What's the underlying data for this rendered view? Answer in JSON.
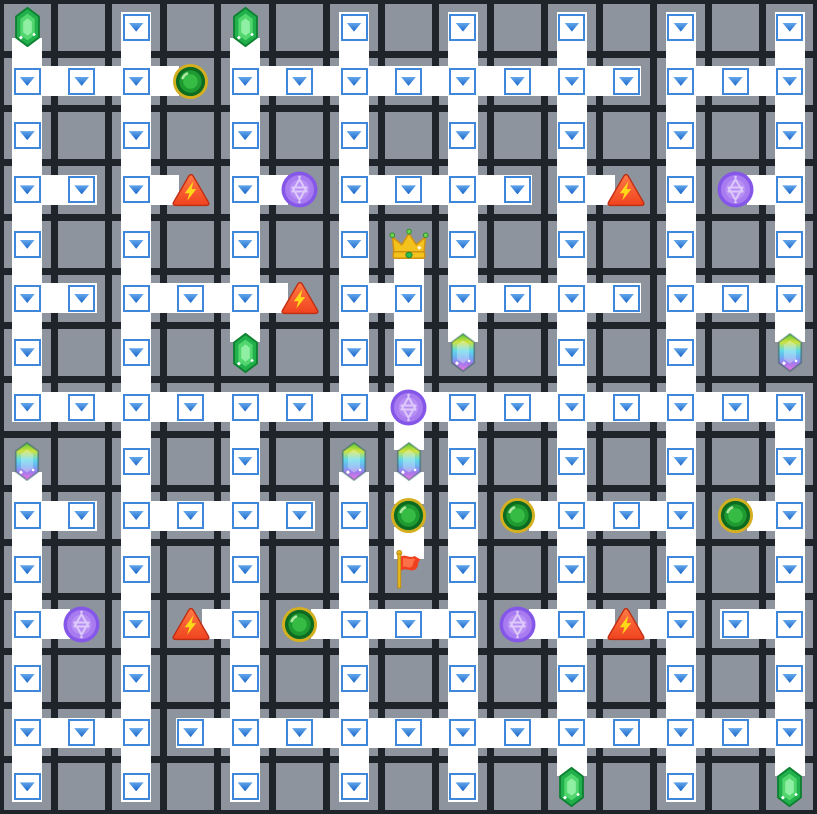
{
  "app": {
    "title": "maze grid puzzle board"
  },
  "board": {
    "cols": 15,
    "rows": 15,
    "colors": {
      "bg": "#1f242b",
      "tile": "#8d949d",
      "path": "#ffffff",
      "boxBorder": "#3e87da",
      "arrowTop": "#63a7ec",
      "arrowBottom": "#1b66c9"
    },
    "path_cells": [
      [
        2,
        0
      ],
      [
        6,
        0
      ],
      [
        8,
        0
      ],
      [
        10,
        0
      ],
      [
        12,
        0
      ],
      [
        14,
        0
      ],
      [
        0,
        1
      ],
      [
        1,
        1
      ],
      [
        2,
        1
      ],
      [
        4,
        1
      ],
      [
        5,
        1
      ],
      [
        6,
        1
      ],
      [
        7,
        1
      ],
      [
        8,
        1
      ],
      [
        9,
        1
      ],
      [
        10,
        1
      ],
      [
        11,
        1
      ],
      [
        12,
        1
      ],
      [
        13,
        1
      ],
      [
        14,
        1
      ],
      [
        0,
        2
      ],
      [
        2,
        2
      ],
      [
        4,
        2
      ],
      [
        6,
        2
      ],
      [
        8,
        2
      ],
      [
        10,
        2
      ],
      [
        12,
        2
      ],
      [
        14,
        2
      ],
      [
        0,
        3
      ],
      [
        1,
        3
      ],
      [
        2,
        3
      ],
      [
        4,
        3
      ],
      [
        6,
        3
      ],
      [
        7,
        3
      ],
      [
        8,
        3
      ],
      [
        9,
        3
      ],
      [
        10,
        3
      ],
      [
        12,
        3
      ],
      [
        14,
        3
      ],
      [
        0,
        4
      ],
      [
        2,
        4
      ],
      [
        4,
        4
      ],
      [
        6,
        4
      ],
      [
        8,
        4
      ],
      [
        10,
        4
      ],
      [
        12,
        4
      ],
      [
        14,
        4
      ],
      [
        0,
        5
      ],
      [
        1,
        5
      ],
      [
        2,
        5
      ],
      [
        3,
        5
      ],
      [
        4,
        5
      ],
      [
        6,
        5
      ],
      [
        7,
        5
      ],
      [
        8,
        5
      ],
      [
        9,
        5
      ],
      [
        10,
        5
      ],
      [
        11,
        5
      ],
      [
        12,
        5
      ],
      [
        13,
        5
      ],
      [
        14,
        5
      ],
      [
        0,
        6
      ],
      [
        2,
        6
      ],
      [
        6,
        6
      ],
      [
        7,
        6
      ],
      [
        10,
        6
      ],
      [
        12,
        6
      ],
      [
        0,
        7
      ],
      [
        1,
        7
      ],
      [
        2,
        7
      ],
      [
        3,
        7
      ],
      [
        4,
        7
      ],
      [
        5,
        7
      ],
      [
        6,
        7
      ],
      [
        8,
        7
      ],
      [
        9,
        7
      ],
      [
        10,
        7
      ],
      [
        11,
        7
      ],
      [
        12,
        7
      ],
      [
        13,
        7
      ],
      [
        14,
        7
      ],
      [
        2,
        8
      ],
      [
        4,
        8
      ],
      [
        8,
        8
      ],
      [
        10,
        8
      ],
      [
        12,
        8
      ],
      [
        14,
        8
      ],
      [
        0,
        9
      ],
      [
        1,
        9
      ],
      [
        2,
        9
      ],
      [
        3,
        9
      ],
      [
        4,
        9
      ],
      [
        5,
        9
      ],
      [
        6,
        9
      ],
      [
        8,
        9
      ],
      [
        10,
        9
      ],
      [
        11,
        9
      ],
      [
        12,
        9
      ],
      [
        14,
        9
      ],
      [
        0,
        10
      ],
      [
        2,
        10
      ],
      [
        4,
        10
      ],
      [
        6,
        10
      ],
      [
        8,
        10
      ],
      [
        10,
        10
      ],
      [
        12,
        10
      ],
      [
        14,
        10
      ],
      [
        0,
        11
      ],
      [
        2,
        11
      ],
      [
        4,
        11
      ],
      [
        6,
        11
      ],
      [
        7,
        11
      ],
      [
        8,
        11
      ],
      [
        10,
        11
      ],
      [
        12,
        11
      ],
      [
        13,
        11
      ],
      [
        14,
        11
      ],
      [
        0,
        12
      ],
      [
        2,
        12
      ],
      [
        4,
        12
      ],
      [
        6,
        12
      ],
      [
        8,
        12
      ],
      [
        10,
        12
      ],
      [
        12,
        12
      ],
      [
        14,
        12
      ],
      [
        0,
        13
      ],
      [
        1,
        13
      ],
      [
        2,
        13
      ],
      [
        3,
        13
      ],
      [
        4,
        13
      ],
      [
        5,
        13
      ],
      [
        6,
        13
      ],
      [
        7,
        13
      ],
      [
        8,
        13
      ],
      [
        9,
        13
      ],
      [
        10,
        13
      ],
      [
        11,
        13
      ],
      [
        12,
        13
      ],
      [
        13,
        13
      ],
      [
        14,
        13
      ],
      [
        0,
        14
      ],
      [
        2,
        14
      ],
      [
        4,
        14
      ],
      [
        6,
        14
      ],
      [
        8,
        14
      ],
      [
        12,
        14
      ]
    ],
    "h_edges": [
      [
        0,
        1
      ],
      [
        1,
        1
      ],
      [
        2,
        1
      ],
      [
        4,
        1
      ],
      [
        5,
        1
      ],
      [
        6,
        1
      ],
      [
        7,
        1
      ],
      [
        8,
        1
      ],
      [
        9,
        1
      ],
      [
        10,
        1
      ],
      [
        12,
        1
      ],
      [
        13,
        1
      ],
      [
        0,
        3
      ],
      [
        2,
        3
      ],
      [
        4,
        3
      ],
      [
        6,
        3
      ],
      [
        7,
        3
      ],
      [
        8,
        3
      ],
      [
        10,
        3
      ],
      [
        13,
        3
      ],
      [
        0,
        5
      ],
      [
        2,
        5
      ],
      [
        3,
        5
      ],
      [
        4,
        5
      ],
      [
        6,
        5
      ],
      [
        8,
        5
      ],
      [
        9,
        5
      ],
      [
        10,
        5
      ],
      [
        12,
        5
      ],
      [
        13,
        5
      ],
      [
        0,
        7
      ],
      [
        1,
        7
      ],
      [
        2,
        7
      ],
      [
        3,
        7
      ],
      [
        4,
        7
      ],
      [
        5,
        7
      ],
      [
        6,
        7
      ],
      [
        7,
        7
      ],
      [
        8,
        7
      ],
      [
        9,
        7
      ],
      [
        10,
        7
      ],
      [
        11,
        7
      ],
      [
        12,
        7
      ],
      [
        13,
        7
      ],
      [
        0,
        9
      ],
      [
        2,
        9
      ],
      [
        3,
        9
      ],
      [
        4,
        9
      ],
      [
        9,
        9
      ],
      [
        10,
        9
      ],
      [
        11,
        9
      ],
      [
        13,
        9
      ],
      [
        0,
        11
      ],
      [
        3,
        11
      ],
      [
        5,
        11
      ],
      [
        6,
        11
      ],
      [
        7,
        11
      ],
      [
        9,
        11
      ],
      [
        10,
        11
      ],
      [
        11,
        11
      ],
      [
        13,
        11
      ],
      [
        0,
        13
      ],
      [
        1,
        13
      ],
      [
        3,
        13
      ],
      [
        4,
        13
      ],
      [
        5,
        13
      ],
      [
        6,
        13
      ],
      [
        7,
        13
      ],
      [
        8,
        13
      ],
      [
        9,
        13
      ],
      [
        10,
        13
      ],
      [
        11,
        13
      ],
      [
        12,
        13
      ],
      [
        13,
        13
      ]
    ],
    "v_edges": [
      [
        0,
        0
      ],
      [
        0,
        1
      ],
      [
        0,
        2
      ],
      [
        0,
        3
      ],
      [
        0,
        4
      ],
      [
        0,
        5
      ],
      [
        0,
        6
      ],
      [
        0,
        8
      ],
      [
        0,
        9
      ],
      [
        0,
        10
      ],
      [
        0,
        11
      ],
      [
        0,
        12
      ],
      [
        0,
        13
      ],
      [
        2,
        0
      ],
      [
        2,
        1
      ],
      [
        2,
        2
      ],
      [
        2,
        3
      ],
      [
        2,
        4
      ],
      [
        2,
        5
      ],
      [
        2,
        6
      ],
      [
        2,
        7
      ],
      [
        2,
        8
      ],
      [
        2,
        9
      ],
      [
        2,
        10
      ],
      [
        2,
        11
      ],
      [
        2,
        12
      ],
      [
        2,
        13
      ],
      [
        4,
        0
      ],
      [
        4,
        1
      ],
      [
        4,
        2
      ],
      [
        4,
        3
      ],
      [
        4,
        4
      ],
      [
        4,
        5
      ],
      [
        4,
        7
      ],
      [
        4,
        8
      ],
      [
        4,
        9
      ],
      [
        4,
        10
      ],
      [
        4,
        11
      ],
      [
        4,
        12
      ],
      [
        4,
        13
      ],
      [
        6,
        0
      ],
      [
        6,
        1
      ],
      [
        6,
        2
      ],
      [
        6,
        3
      ],
      [
        6,
        4
      ],
      [
        6,
        5
      ],
      [
        6,
        6
      ],
      [
        6,
        8
      ],
      [
        6,
        9
      ],
      [
        6,
        10
      ],
      [
        6,
        11
      ],
      [
        6,
        12
      ],
      [
        6,
        13
      ],
      [
        7,
        4
      ],
      [
        7,
        5
      ],
      [
        7,
        6
      ],
      [
        7,
        7
      ],
      [
        7,
        8
      ],
      [
        7,
        9
      ],
      [
        8,
        0
      ],
      [
        8,
        1
      ],
      [
        8,
        2
      ],
      [
        8,
        3
      ],
      [
        8,
        4
      ],
      [
        8,
        5
      ],
      [
        8,
        7
      ],
      [
        8,
        8
      ],
      [
        8,
        9
      ],
      [
        8,
        10
      ],
      [
        8,
        11
      ],
      [
        8,
        12
      ],
      [
        8,
        13
      ],
      [
        10,
        0
      ],
      [
        10,
        1
      ],
      [
        10,
        2
      ],
      [
        10,
        3
      ],
      [
        10,
        4
      ],
      [
        10,
        5
      ],
      [
        10,
        6
      ],
      [
        10,
        7
      ],
      [
        10,
        8
      ],
      [
        10,
        9
      ],
      [
        10,
        10
      ],
      [
        10,
        11
      ],
      [
        10,
        12
      ],
      [
        10,
        13
      ],
      [
        12,
        0
      ],
      [
        12,
        1
      ],
      [
        12,
        2
      ],
      [
        12,
        3
      ],
      [
        12,
        4
      ],
      [
        12,
        5
      ],
      [
        12,
        6
      ],
      [
        12,
        7
      ],
      [
        12,
        8
      ],
      [
        12,
        9
      ],
      [
        12,
        10
      ],
      [
        12,
        11
      ],
      [
        12,
        12
      ],
      [
        12,
        13
      ],
      [
        14,
        0
      ],
      [
        14,
        1
      ],
      [
        14,
        2
      ],
      [
        14,
        3
      ],
      [
        14,
        4
      ],
      [
        14,
        5
      ],
      [
        14,
        7
      ],
      [
        14,
        8
      ],
      [
        14,
        9
      ],
      [
        14,
        10
      ],
      [
        14,
        11
      ],
      [
        14,
        12
      ],
      [
        14,
        13
      ]
    ],
    "icons": [
      {
        "x": 0,
        "y": 0,
        "type": "emerald-gem"
      },
      {
        "x": 4,
        "y": 0,
        "type": "emerald-gem"
      },
      {
        "x": 3,
        "y": 1,
        "type": "green-orb"
      },
      {
        "x": 3,
        "y": 3,
        "type": "hazard-triangle"
      },
      {
        "x": 5,
        "y": 3,
        "type": "purple-orb"
      },
      {
        "x": 11,
        "y": 3,
        "type": "hazard-triangle"
      },
      {
        "x": 13,
        "y": 3,
        "type": "purple-orb"
      },
      {
        "x": 7,
        "y": 4,
        "type": "crown"
      },
      {
        "x": 5,
        "y": 5,
        "type": "hazard-triangle"
      },
      {
        "x": 4,
        "y": 6,
        "type": "emerald-gem"
      },
      {
        "x": 8,
        "y": 6,
        "type": "rainbow-crystal"
      },
      {
        "x": 14,
        "y": 6,
        "type": "rainbow-crystal"
      },
      {
        "x": 7,
        "y": 7,
        "type": "purple-orb"
      },
      {
        "x": 0,
        "y": 8,
        "type": "rainbow-crystal"
      },
      {
        "x": 6,
        "y": 8,
        "type": "rainbow-crystal"
      },
      {
        "x": 7,
        "y": 8,
        "type": "rainbow-crystal"
      },
      {
        "x": 7,
        "y": 9,
        "type": "green-orb"
      },
      {
        "x": 9,
        "y": 9,
        "type": "green-orb"
      },
      {
        "x": 13,
        "y": 9,
        "type": "green-orb"
      },
      {
        "x": 7,
        "y": 10,
        "type": "flag"
      },
      {
        "x": 1,
        "y": 11,
        "type": "purple-orb"
      },
      {
        "x": 3,
        "y": 11,
        "type": "hazard-triangle"
      },
      {
        "x": 5,
        "y": 11,
        "type": "green-orb"
      },
      {
        "x": 9,
        "y": 11,
        "type": "purple-orb"
      },
      {
        "x": 11,
        "y": 11,
        "type": "hazard-triangle"
      },
      {
        "x": 10,
        "y": 14,
        "type": "emerald-gem"
      },
      {
        "x": 14,
        "y": 14,
        "type": "emerald-gem"
      }
    ]
  },
  "icon_types": {
    "emerald-gem": {
      "label": "green gem",
      "colors": {
        "outline": "#0e8132",
        "body": "#21b04b",
        "mid": "#52d66e",
        "light": "#8ff0a4"
      }
    },
    "rainbow-crystal": {
      "label": "rainbow crystal",
      "colors": {
        "stops": [
          "#57c83c",
          "#cfe23e",
          "#5fd9e8",
          "#6db0f2",
          "#a678ec",
          "#f07ae0"
        ],
        "overlay": "rgba(255,255,255,0.30)"
      }
    },
    "green-orb": {
      "label": "green portal orb",
      "colors": {
        "ring": "#d4af1f",
        "dark": "#0d6b21",
        "mid": "#1f9a31",
        "inner": "#36bb44",
        "glint": "#aee8a4"
      }
    },
    "purple-orb": {
      "label": "purple rune orb",
      "colors": {
        "ring": "#8557e8",
        "fill": "#a87cf0",
        "inner": "#b78ff4",
        "star": "#ddc8fb"
      }
    },
    "hazard-triangle": {
      "label": "lightning hazard sign",
      "colors": {
        "fill": "#f0431f",
        "top": "#ff7a45",
        "stroke": "#bf2d12",
        "bolt": "#ffd818"
      }
    },
    "crown": {
      "label": "gold crown",
      "colors": {
        "gold": "#f4c21c",
        "dark": "#cf9212",
        "tip": "#6fd44f",
        "tipStroke": "#2f8f2f",
        "gem": "#2fbf4f",
        "gemStroke": "#148a36"
      }
    },
    "flag": {
      "label": "red flag",
      "colors": {
        "pole": "#e7b91c",
        "poleStroke": "#b8860b",
        "cloth": "#f04020",
        "clothLight": "#ff7a50"
      }
    }
  }
}
